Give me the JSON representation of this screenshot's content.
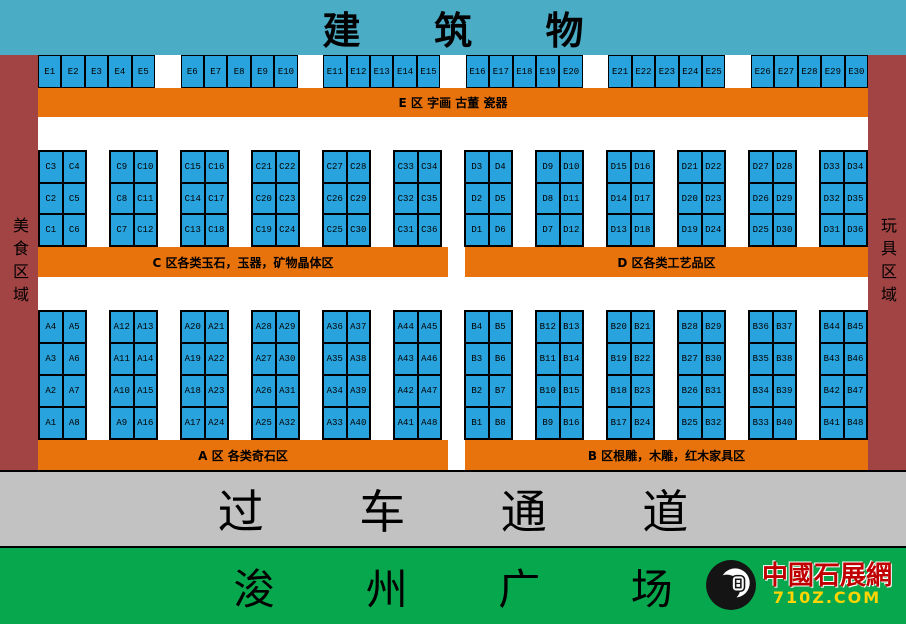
{
  "building_label": "建 筑 物",
  "road_label": "过 车 通 道",
  "plaza_label": "浚 州 广 场",
  "sidebars": {
    "left": "美食区域",
    "right": "玩具区域"
  },
  "logo": {
    "name": "中國石展網",
    "url": "710Z.COM",
    "icon": "stone-seal-icon"
  },
  "colors": {
    "banner_teal": "#4BACC6",
    "booth_blue": "#29A3DD",
    "zone_orange": "#E8720C",
    "corridor_red": "#A34444",
    "road_gray": "#C2C2C2",
    "plaza_green": "#07A74D",
    "logo_red": "#C00000",
    "logo_gold": "#FFD400"
  },
  "zones": {
    "E": {
      "bar_label": "E  区 字画 古董 瓷器",
      "groups": [
        [
          "E1",
          "E2",
          "E3",
          "E4",
          "E5"
        ],
        [
          "E6",
          "E7",
          "E8",
          "E9",
          "E10"
        ],
        [
          "E11",
          "E12",
          "E13",
          "E14",
          "E15"
        ],
        [
          "E16",
          "E17",
          "E18",
          "E19",
          "E20"
        ],
        [
          "E21",
          "E22",
          "E23",
          "E24",
          "E25"
        ],
        [
          "E26",
          "E27",
          "E28",
          "E29",
          "E30"
        ]
      ]
    },
    "C": {
      "bar_label": "C  区各类玉石，玉器，矿物晶体区",
      "blocks": [
        [
          [
            "C3",
            "C4"
          ],
          [
            "C2",
            "C5"
          ],
          [
            "C1",
            "C6"
          ]
        ],
        [
          [
            "C9",
            "C10"
          ],
          [
            "C8",
            "C11"
          ],
          [
            "C7",
            "C12"
          ]
        ],
        [
          [
            "C15",
            "C16"
          ],
          [
            "C14",
            "C17"
          ],
          [
            "C13",
            "C18"
          ]
        ],
        [
          [
            "C21",
            "C22"
          ],
          [
            "C20",
            "C23"
          ],
          [
            "C19",
            "C24"
          ]
        ],
        [
          [
            "C27",
            "C28"
          ],
          [
            "C26",
            "C29"
          ],
          [
            "C25",
            "C30"
          ]
        ],
        [
          [
            "C33",
            "C34"
          ],
          [
            "C32",
            "C35"
          ],
          [
            "C31",
            "C36"
          ]
        ]
      ]
    },
    "D": {
      "bar_label": "D  区各类工艺品区",
      "blocks": [
        [
          [
            "D3",
            "D4"
          ],
          [
            "D2",
            "D5"
          ],
          [
            "D1",
            "D6"
          ]
        ],
        [
          [
            "D9",
            "D10"
          ],
          [
            "D8",
            "D11"
          ],
          [
            "D7",
            "D12"
          ]
        ],
        [
          [
            "D15",
            "D16"
          ],
          [
            "D14",
            "D17"
          ],
          [
            "D13",
            "D18"
          ]
        ],
        [
          [
            "D21",
            "D22"
          ],
          [
            "D20",
            "D23"
          ],
          [
            "D19",
            "D24"
          ]
        ],
        [
          [
            "D27",
            "D28"
          ],
          [
            "D26",
            "D29"
          ],
          [
            "D25",
            "D30"
          ]
        ],
        [
          [
            "D33",
            "D34"
          ],
          [
            "D32",
            "D35"
          ],
          [
            "D31",
            "D36"
          ]
        ]
      ]
    },
    "A": {
      "bar_label": "A  区 各类奇石区",
      "blocks": [
        [
          [
            "A4",
            "A5"
          ],
          [
            "A3",
            "A6"
          ],
          [
            "A2",
            "A7"
          ],
          [
            "A1",
            "A8"
          ]
        ],
        [
          [
            "A12",
            "A13"
          ],
          [
            "A11",
            "A14"
          ],
          [
            "A10",
            "A15"
          ],
          [
            "A9",
            "A16"
          ]
        ],
        [
          [
            "A20",
            "A21"
          ],
          [
            "A19",
            "A22"
          ],
          [
            "A18",
            "A23"
          ],
          [
            "A17",
            "A24"
          ]
        ],
        [
          [
            "A28",
            "A29"
          ],
          [
            "A27",
            "A30"
          ],
          [
            "A26",
            "A31"
          ],
          [
            "A25",
            "A32"
          ]
        ],
        [
          [
            "A36",
            "A37"
          ],
          [
            "A35",
            "A38"
          ],
          [
            "A34",
            "A39"
          ],
          [
            "A33",
            "A40"
          ]
        ],
        [
          [
            "A44",
            "A45"
          ],
          [
            "A43",
            "A46"
          ],
          [
            "A42",
            "A47"
          ],
          [
            "A41",
            "A48"
          ]
        ]
      ]
    },
    "B": {
      "bar_label": "B  区根雕，木雕，红木家具区",
      "blocks": [
        [
          [
            "B4",
            "B5"
          ],
          [
            "B3",
            "B6"
          ],
          [
            "B2",
            "B7"
          ],
          [
            "B1",
            "B8"
          ]
        ],
        [
          [
            "B12",
            "B13"
          ],
          [
            "B11",
            "B14"
          ],
          [
            "B10",
            "B15"
          ],
          [
            "B9",
            "B16"
          ]
        ],
        [
          [
            "B20",
            "B21"
          ],
          [
            "B19",
            "B22"
          ],
          [
            "B18",
            "B23"
          ],
          [
            "B17",
            "B24"
          ]
        ],
        [
          [
            "B28",
            "B29"
          ],
          [
            "B27",
            "B30"
          ],
          [
            "B26",
            "B31"
          ],
          [
            "B25",
            "B32"
          ]
        ],
        [
          [
            "B36",
            "B37"
          ],
          [
            "B35",
            "B38"
          ],
          [
            "B34",
            "B39"
          ],
          [
            "B33",
            "B40"
          ]
        ],
        [
          [
            "B44",
            "B45"
          ],
          [
            "B43",
            "B46"
          ],
          [
            "B42",
            "B47"
          ],
          [
            "B41",
            "B48"
          ]
        ]
      ]
    }
  }
}
